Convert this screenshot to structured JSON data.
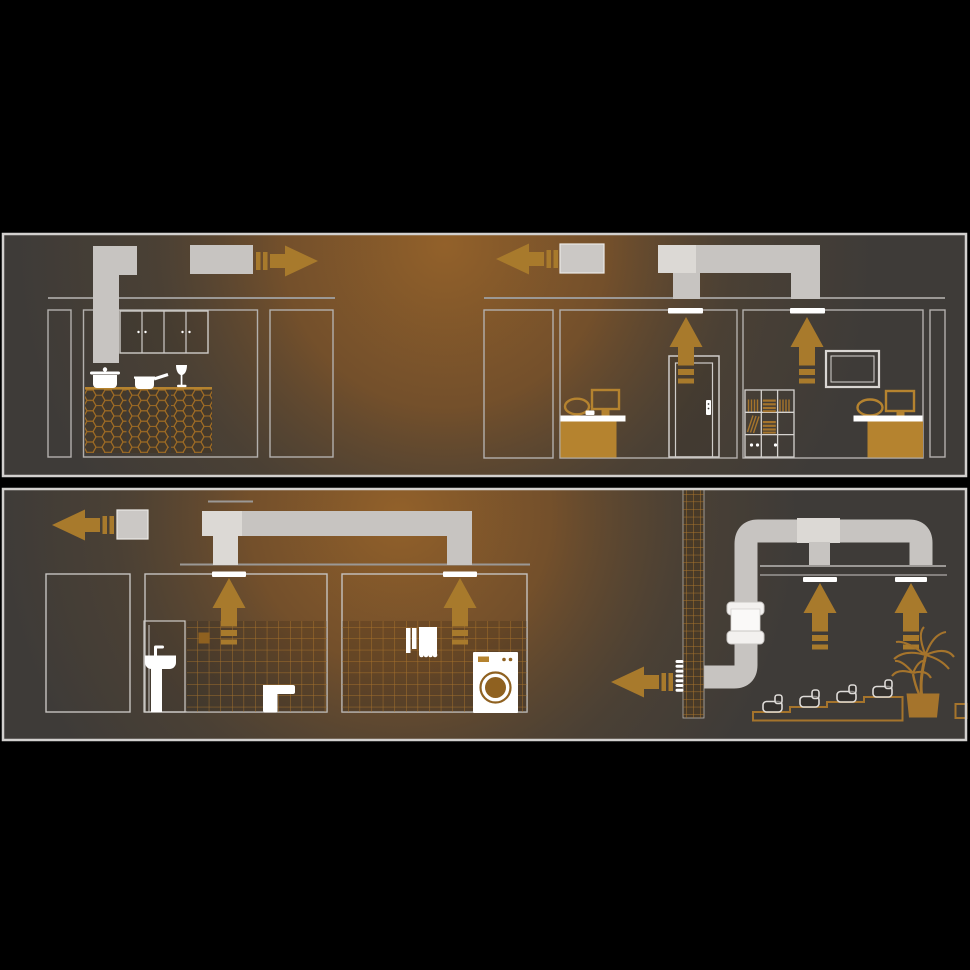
{
  "scene": {
    "type": "ventilation-system-cross-section-illustration",
    "panels": [
      {
        "name": "kitchen-and-office-section",
        "rooms": [
          "kitchen",
          "closet",
          "office-room-with-door",
          "office-room-with-shelf-and-tv"
        ],
        "elements": [
          "kitchen-hood-duct",
          "exhaust-duct-segment",
          "airflow-arrow-right",
          "wall-cabinets",
          "hex-tiled-island",
          "cooking-pot",
          "saucepan",
          "wine-glass",
          "ceiling-tee-duct",
          "airflow-arrow-left",
          "ceiling-extract-vents",
          "airflow-up-arrows",
          "office-desk",
          "office-monitor",
          "office-chair",
          "door",
          "bookshelf",
          "wall-tv"
        ]
      },
      {
        "name": "bathroom-laundry-and-lounge-section",
        "rooms": [
          "closet",
          "bathroom",
          "laundry-room",
          "lounge-theater"
        ],
        "elements": [
          "roof-line",
          "exhaust-box",
          "airflow-arrow-left",
          "ceiling-duct-run",
          "ceiling-extract-vents",
          "airflow-up-arrows",
          "washbasin",
          "toilet",
          "wall-tiles",
          "towels",
          "washing-machine",
          "tiled-riser-shaft",
          "round-duct-run",
          "inline-duct-fan",
          "wall-louver-vent",
          "tiered-seating-steps",
          "lounge-chairs",
          "palm-plant",
          "planter-pot"
        ]
      }
    ]
  },
  "colors": {
    "background": "#000000",
    "panel_base": "#3e3b38",
    "panel_border": "#d2d0ce",
    "glow_warm": "#95622a",
    "glow_mid": "#7f5428",
    "glow_low": "#5d482f",
    "duct": "#c7c4c1",
    "duct_light": "#dcd9d5",
    "duct_box": "#cbc8c5",
    "white": "#ffffff",
    "outline": "#b3b0ad",
    "ceiling": "#9b9895",
    "arrow": "#a87a2c",
    "furniture": "#b5832f",
    "accent_dark": "#8f6120",
    "hex_tile": "#a06c24",
    "tile_grid": "#b47a2d",
    "steps": "#a5742c",
    "counter_dark": "#44392b",
    "chimney_fill": "#483a28"
  }
}
